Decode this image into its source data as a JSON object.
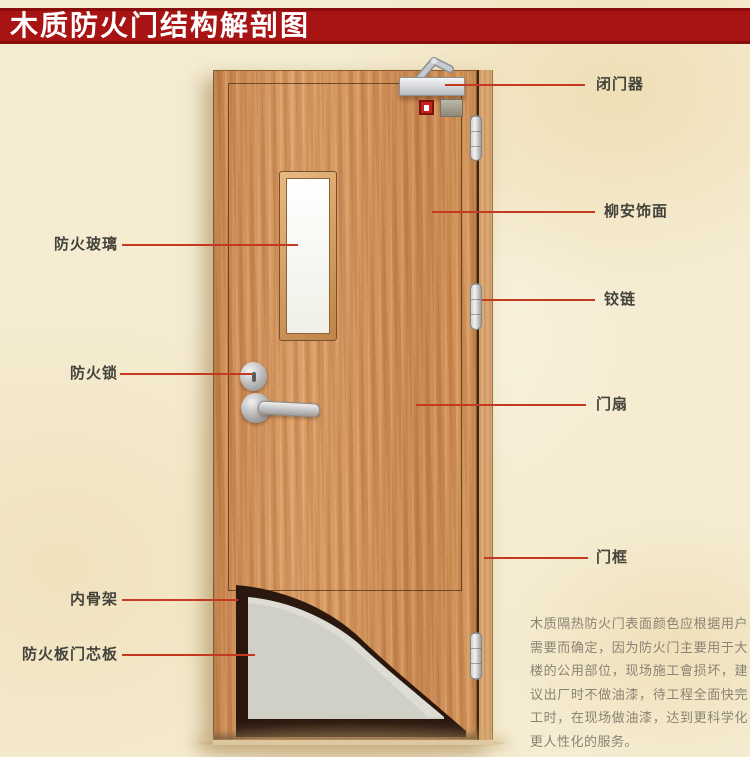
{
  "banner": {
    "title": "木质防火门结构解剖图"
  },
  "labels": {
    "left": [
      {
        "text": "防火玻璃"
      },
      {
        "text": "防火锁"
      },
      {
        "text": "内骨架"
      },
      {
        "text": "防火板门芯板"
      }
    ],
    "right": [
      {
        "text": "闭门器"
      },
      {
        "text": "柳安饰面"
      },
      {
        "text": "铰链"
      },
      {
        "text": "门扇"
      },
      {
        "text": "门框"
      }
    ]
  },
  "description": "木质隔热防火门表面颜色应根据用户需要而确定，因为防火门主要用于大楼的公用部位，现场施工會损坏，建议出厂时不做油漆，待工程全面快完工时，在现场做油漆，达到更科学化更人性化的服务。",
  "colors": {
    "banner_red": "#a81414",
    "leader_line": "#c43a20",
    "door_wood": "#d09057",
    "frame_wood": "#dba873",
    "core_board_grey": "#d0d0c6",
    "inner_skeleton_dark": "#2a170e",
    "background_beige": "#f5ecd2"
  }
}
